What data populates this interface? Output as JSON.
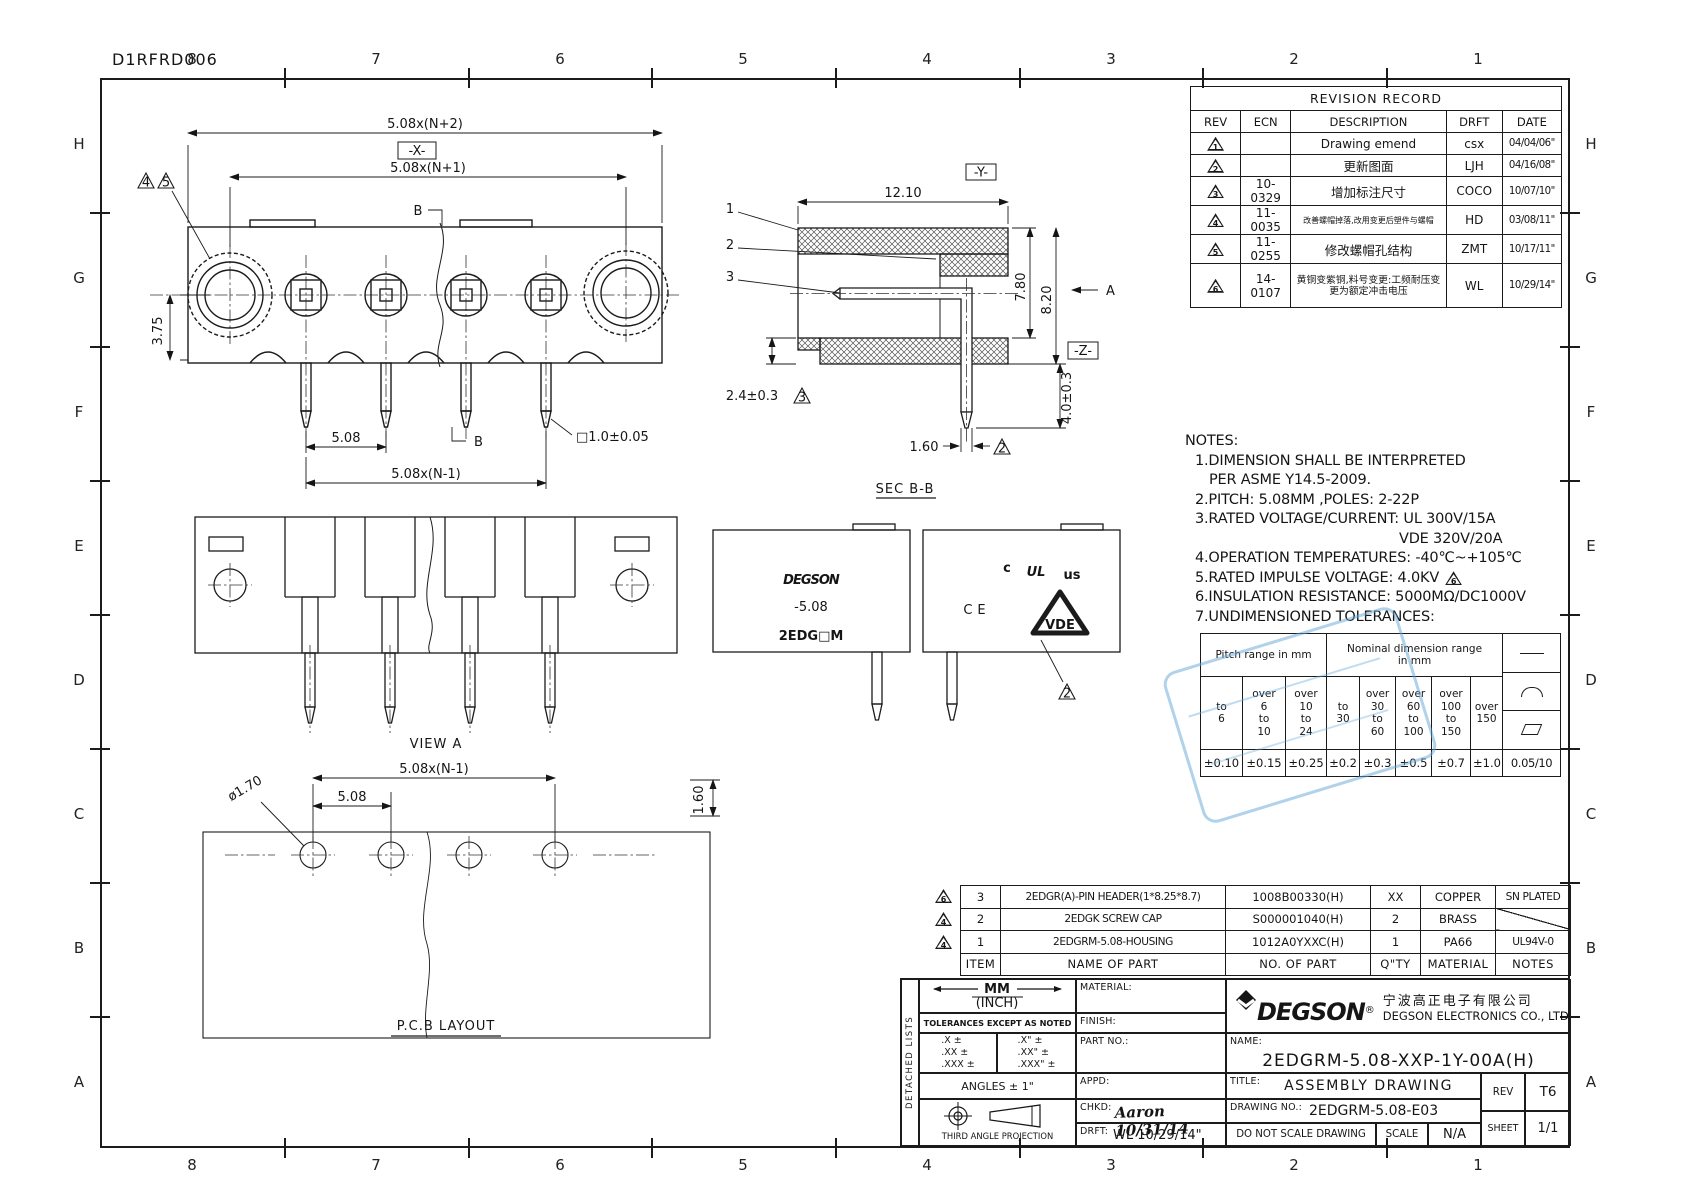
{
  "doc_number": "D1RFRD006",
  "grid": {
    "cols": [
      "8",
      "7",
      "6",
      "5",
      "4",
      "3",
      "2",
      "1"
    ],
    "rows": [
      "H",
      "G",
      "F",
      "E",
      "D",
      "C",
      "B",
      "A"
    ]
  },
  "revision_table": {
    "title": "REVISION RECORD",
    "headers": {
      "rev": "REV",
      "ecn": "ECN",
      "description": "DESCRIPTION",
      "drft": "DRFT",
      "date": "DATE"
    },
    "rows": [
      {
        "rev": "1",
        "ecn": "",
        "description": "Drawing emend",
        "drft": "csx",
        "date": "04/04/06\""
      },
      {
        "rev": "2",
        "ecn": "",
        "description": "更新图面",
        "drft": "LJH",
        "date": "04/16/08\""
      },
      {
        "rev": "3",
        "ecn": "10-0329",
        "description": "增加标注尺寸",
        "drft": "COCO",
        "date": "10/07/10\""
      },
      {
        "rev": "4",
        "ecn": "11-0035",
        "description": "改善螺帽掉落,改用变更后塑件与螺帽",
        "drft": "HD",
        "date": "03/08/11\""
      },
      {
        "rev": "5",
        "ecn": "11-0255",
        "description": "修改螺帽孔结构",
        "drft": "ZMT",
        "date": "10/17/11\""
      },
      {
        "rev": "6",
        "ecn": "14-0107",
        "description": "黄铜变紫铜,料号变更:工频耐压变更为额定冲击电压",
        "drft": "WL",
        "date": "10/29/14\""
      }
    ]
  },
  "notes": {
    "title": "NOTES:",
    "line1": "1.DIMENSION SHALL BE INTERPRETED",
    "line1b": "PER ASME Y14.5-2009.",
    "line2": "2.PITCH: 5.08MM ,POLES: 2-22P",
    "line3": "3.RATED VOLTAGE/CURRENT: UL  300V/15A",
    "line3b": "VDE 320V/20A",
    "line4": "4.OPERATION TEMPERATURES: -40℃~+105℃",
    "line5": "5.RATED IMPULSE VOLTAGE: 4.0KV",
    "line5_flag": "6",
    "line6": "6.INSULATION RESISTANCE: 5000MΩ/DC1000V",
    "line7": "7.UNDIMENSIONED TOLERANCES:"
  },
  "tolerance_table": {
    "pitch_header": "Pitch range in mm",
    "nominal_header": "Nominal dimension range\nin mm",
    "ranges": [
      "to\n6",
      "over\n6\nto\n10",
      "over\n10\nto\n24",
      "to\n30",
      "over\n30\nto\n60",
      "over\n60\nto\n100",
      "over\n100\nto\n150",
      "over\n150"
    ],
    "symbol_icons": [
      "straight-line",
      "arc",
      "parallelogram"
    ],
    "values": [
      "±0.10",
      "±0.15",
      "±0.25",
      "±0.2",
      "±0.3",
      "±0.5",
      "±0.7",
      "±1.0",
      "0.05/10"
    ]
  },
  "bom": {
    "headers": {
      "item": "ITEM",
      "name": "NAME OF PART",
      "no": "NO. OF PART",
      "qty": "Q\"TY",
      "material": "MATERIAL",
      "notes": "NOTES"
    },
    "rows": [
      {
        "flag": "6",
        "item": "3",
        "name": "2EDGR(A)-PIN HEADER(1*8.25*8.7)",
        "no": "1008B00330(H)",
        "qty": "XX",
        "material": "COPPER",
        "notes": "SN PLATED"
      },
      {
        "flag": "4",
        "item": "2",
        "name": "2EDGK SCREW CAP",
        "no": "S000001040(H)",
        "qty": "2",
        "material": "BRASS",
        "notes": ""
      },
      {
        "flag": "4",
        "item": "1",
        "name": "2EDGRM-5.08-HOUSING",
        "no": "1012A0YXXC(H)",
        "qty": "1",
        "material": "PA66",
        "notes": "UL94V-0"
      }
    ]
  },
  "title_block": {
    "detached_lists": "DETACHED LISTS",
    "units_mm": "MM",
    "units_inch": "(INCH)",
    "tolerances_note": "TOLERANCES EXCEPT AS NOTED",
    "tol_mm": ".X ±\n.XX ±\n.XXX ±",
    "tol_inch": ".X\" ±\n.XX\" ±\n.XXX\" ±",
    "angles": "ANGLES ± 1\"",
    "projection": "THIRD ANGLE PROJECTION",
    "material_label": "MATERIAL:",
    "finish_label": "FINISH:",
    "part_no_label": "PART NO.:",
    "appd_label": "APPD:",
    "chkd_label": "CHKD:",
    "chkd_value": "Aaron 10/31/14",
    "drft_label": "DRFT:",
    "drft_value": "WL 10/29/14\"",
    "brand": "DEGSON",
    "brand_reg": "®",
    "company_cn": "宁波高正电子有限公司",
    "company_en": "DEGSON ELECTRONICS CO., LTD",
    "name_label": "NAME:",
    "name_value": "2EDGRM-5.08-XXP-1Y-00A(H)",
    "title_label": "TITLE:",
    "title_value": "ASSEMBLY DRAWING",
    "drawing_no_label": "DRAWING NO.:",
    "drawing_no_value": "2EDGRM-5.08-E03",
    "do_not_scale": "DO NOT SCALE DRAWING",
    "scale_label": "SCALE",
    "scale_value": "N/A",
    "rev_label": "REV",
    "rev_value": "T6",
    "sheet_label": "SHEET",
    "sheet_value": "1/1"
  },
  "front_view": {
    "dim_n2": "5.08x(N+2)",
    "datum_x": "-X-",
    "dim_n1": "5.08x(N+1)",
    "dim_375": "3.75",
    "dim_508": "5.08",
    "dim_nm1": "5.08x(N-1)",
    "dim_pin": "□1.0±0.05",
    "cut_label": "B",
    "flag_a": "4",
    "flag_b": "5"
  },
  "section_view": {
    "label": "SEC B-B",
    "dim_width": "12.10",
    "dim_780": "7.80",
    "dim_820": "8.20",
    "arrow_label": "A",
    "datum_y": "-Y-",
    "datum_z": "-Z-",
    "dim_24": "2.4±0.3",
    "dim_40": "4.0±0.3",
    "dim_160": "1.60",
    "flag_3": "3",
    "flag_2": "2",
    "callout_1": "1",
    "callout_2": "2",
    "callout_3": "3"
  },
  "view_a": {
    "label": "VIEW A"
  },
  "side_view": {
    "brand": "DEGSON",
    "pitch": "-5.08",
    "model": "2EDG□M",
    "cert_c": "c",
    "cert_ul": "UL",
    "cert_us": "us",
    "cert_ce": "CE",
    "cert_vde": "VDE",
    "flag_2": "2"
  },
  "pcb_view": {
    "label": "P.C.B LAYOUT",
    "dim_nm1": "5.08x(N-1)",
    "dim_508": "5.08",
    "dim_dia": "ø1.70",
    "dim_160": "1.60"
  }
}
